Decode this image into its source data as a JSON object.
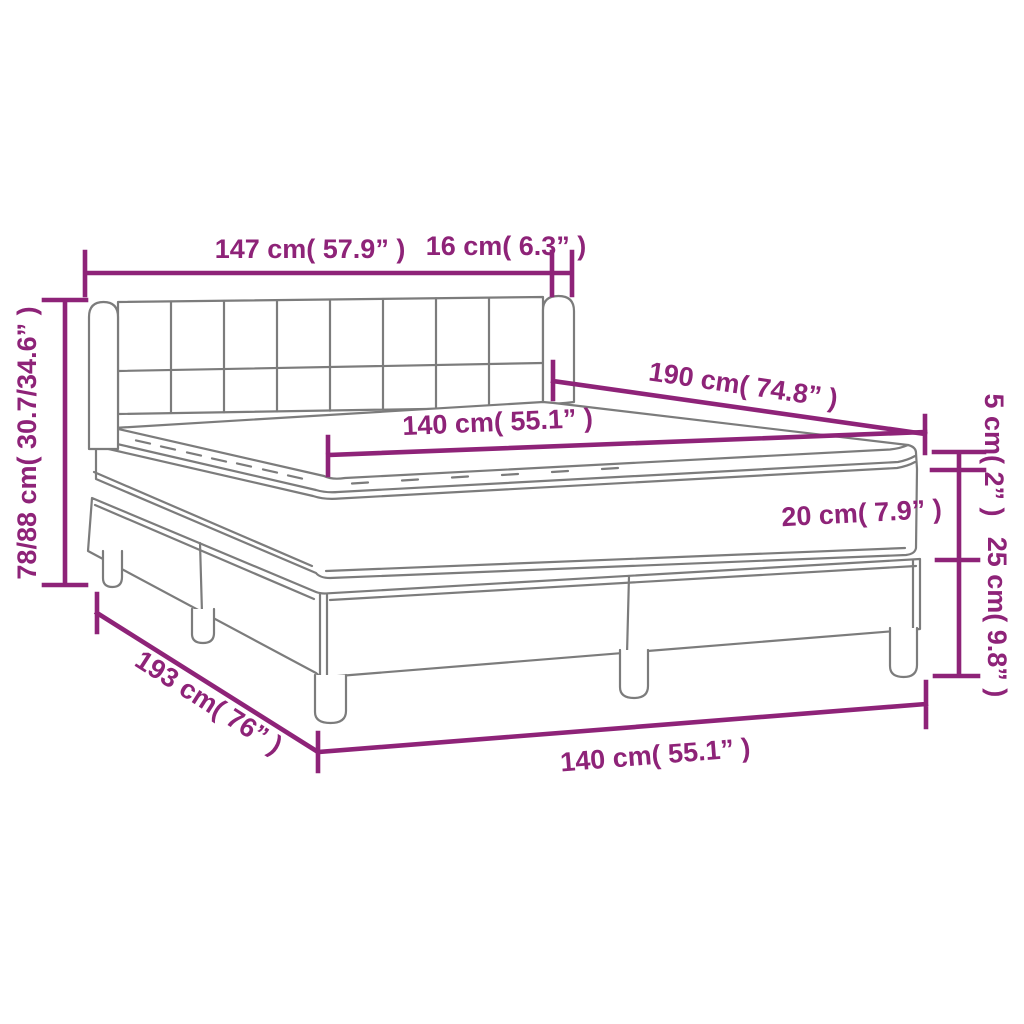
{
  "figure": {
    "subject": "Box spring bed with upholstered tufted headboard, mattress with pillow-top topper and wooden legs — dimension diagram",
    "background": "#FFFFFF",
    "line_color": "#7C7C7C",
    "dimension_color": "#8E2378"
  },
  "dimensions": [
    {
      "part": "headboard-width",
      "cm": "147",
      "inch": "57.9",
      "label": "147 cm( 57.9” )"
    },
    {
      "part": "headboard-wing-depth",
      "cm": "16",
      "inch": "6.3",
      "label": "16 cm( 6.3” )"
    },
    {
      "part": "overall-height",
      "cm": "78/88",
      "inch": "30.7/34.6",
      "label": "78/88 cm( 30.7/34.6” )"
    },
    {
      "part": "bed-length-top",
      "cm": "190",
      "inch": "74.8",
      "label": "190 cm( 74.8” )"
    },
    {
      "part": "mattress-width",
      "cm": "140",
      "inch": "55.1",
      "label": "140 cm( 55.1” )"
    },
    {
      "part": "topper-thickness",
      "cm": "5",
      "inch": "2",
      "label": "5 cm( 2” )"
    },
    {
      "part": "mattress-thickness",
      "cm": "20",
      "inch": "7.9",
      "label": "20 cm( 7.9” )"
    },
    {
      "part": "base-height",
      "cm": "25",
      "inch": "9.8",
      "label": "25 cm( 9.8” )"
    },
    {
      "part": "overall-length",
      "cm": "193",
      "inch": "76",
      "label": "193 cm( 76” )"
    },
    {
      "part": "overall-width",
      "cm": "140",
      "inch": "55.1",
      "label": "140 cm( 55.1” )"
    }
  ]
}
